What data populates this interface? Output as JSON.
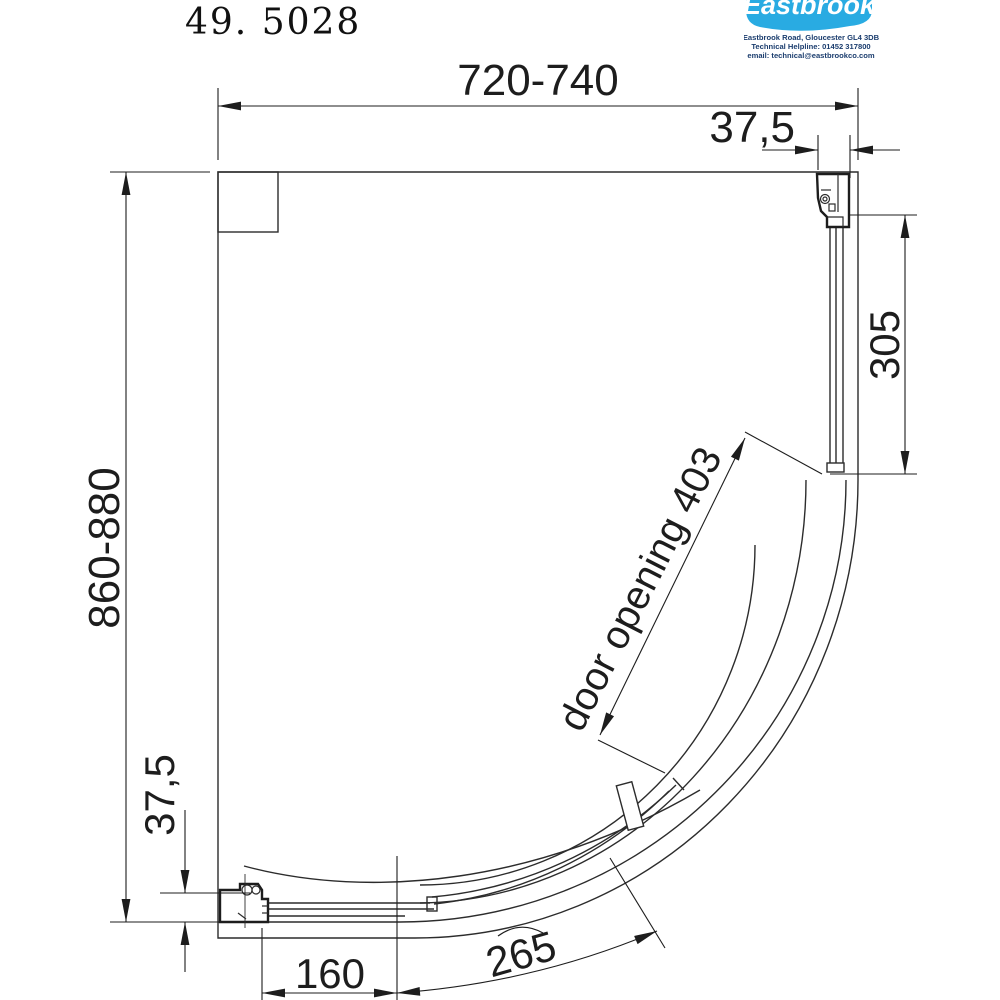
{
  "title": "49. 5028",
  "logo": {
    "brand": "Eastbrook",
    "address_line1": "Eastbrook Road, Gloucester GL4 3DB",
    "address_line2": "Technical Helpline: 01452 317800",
    "address_line3": "email: technical@eastbrookco.com",
    "brand_color": "#29abe2"
  },
  "drawing": {
    "description": "quadrant shower enclosure plan view",
    "line_color": "#222222",
    "dimensions": {
      "overall_width": "720-740",
      "overall_height": "860-880",
      "wall_profile_top": "37,5",
      "wall_profile_bottom": "37,5",
      "fixed_side_panel": "305",
      "fixed_bottom_panel": "160",
      "curved_panel": "265",
      "door_opening": "door opening 403"
    }
  }
}
